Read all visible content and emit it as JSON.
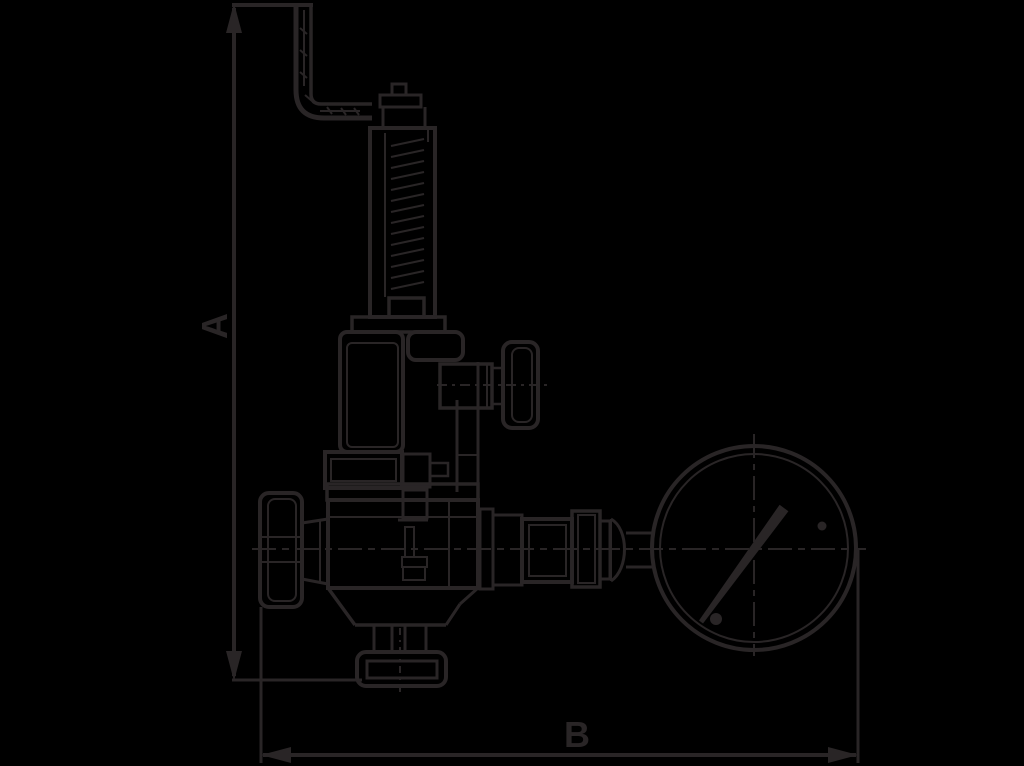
{
  "figure": {
    "kind": "technical line drawing",
    "subject": "safety relief valve with test lever, shut-off handwheel and pressure gauge",
    "labels": {
      "dimension_a": "A",
      "dimension_b": "B"
    },
    "colors": {
      "background": "#000000",
      "line": "#292526"
    },
    "parts": [
      "test-lever",
      "adjusting-spindle",
      "spring-housing",
      "bonnet",
      "gauge-cock",
      "valve-body",
      "handwheel",
      "outlet-flange",
      "gauge-piping",
      "pressure-gauge",
      "dimension-a",
      "dimension-b"
    ]
  }
}
